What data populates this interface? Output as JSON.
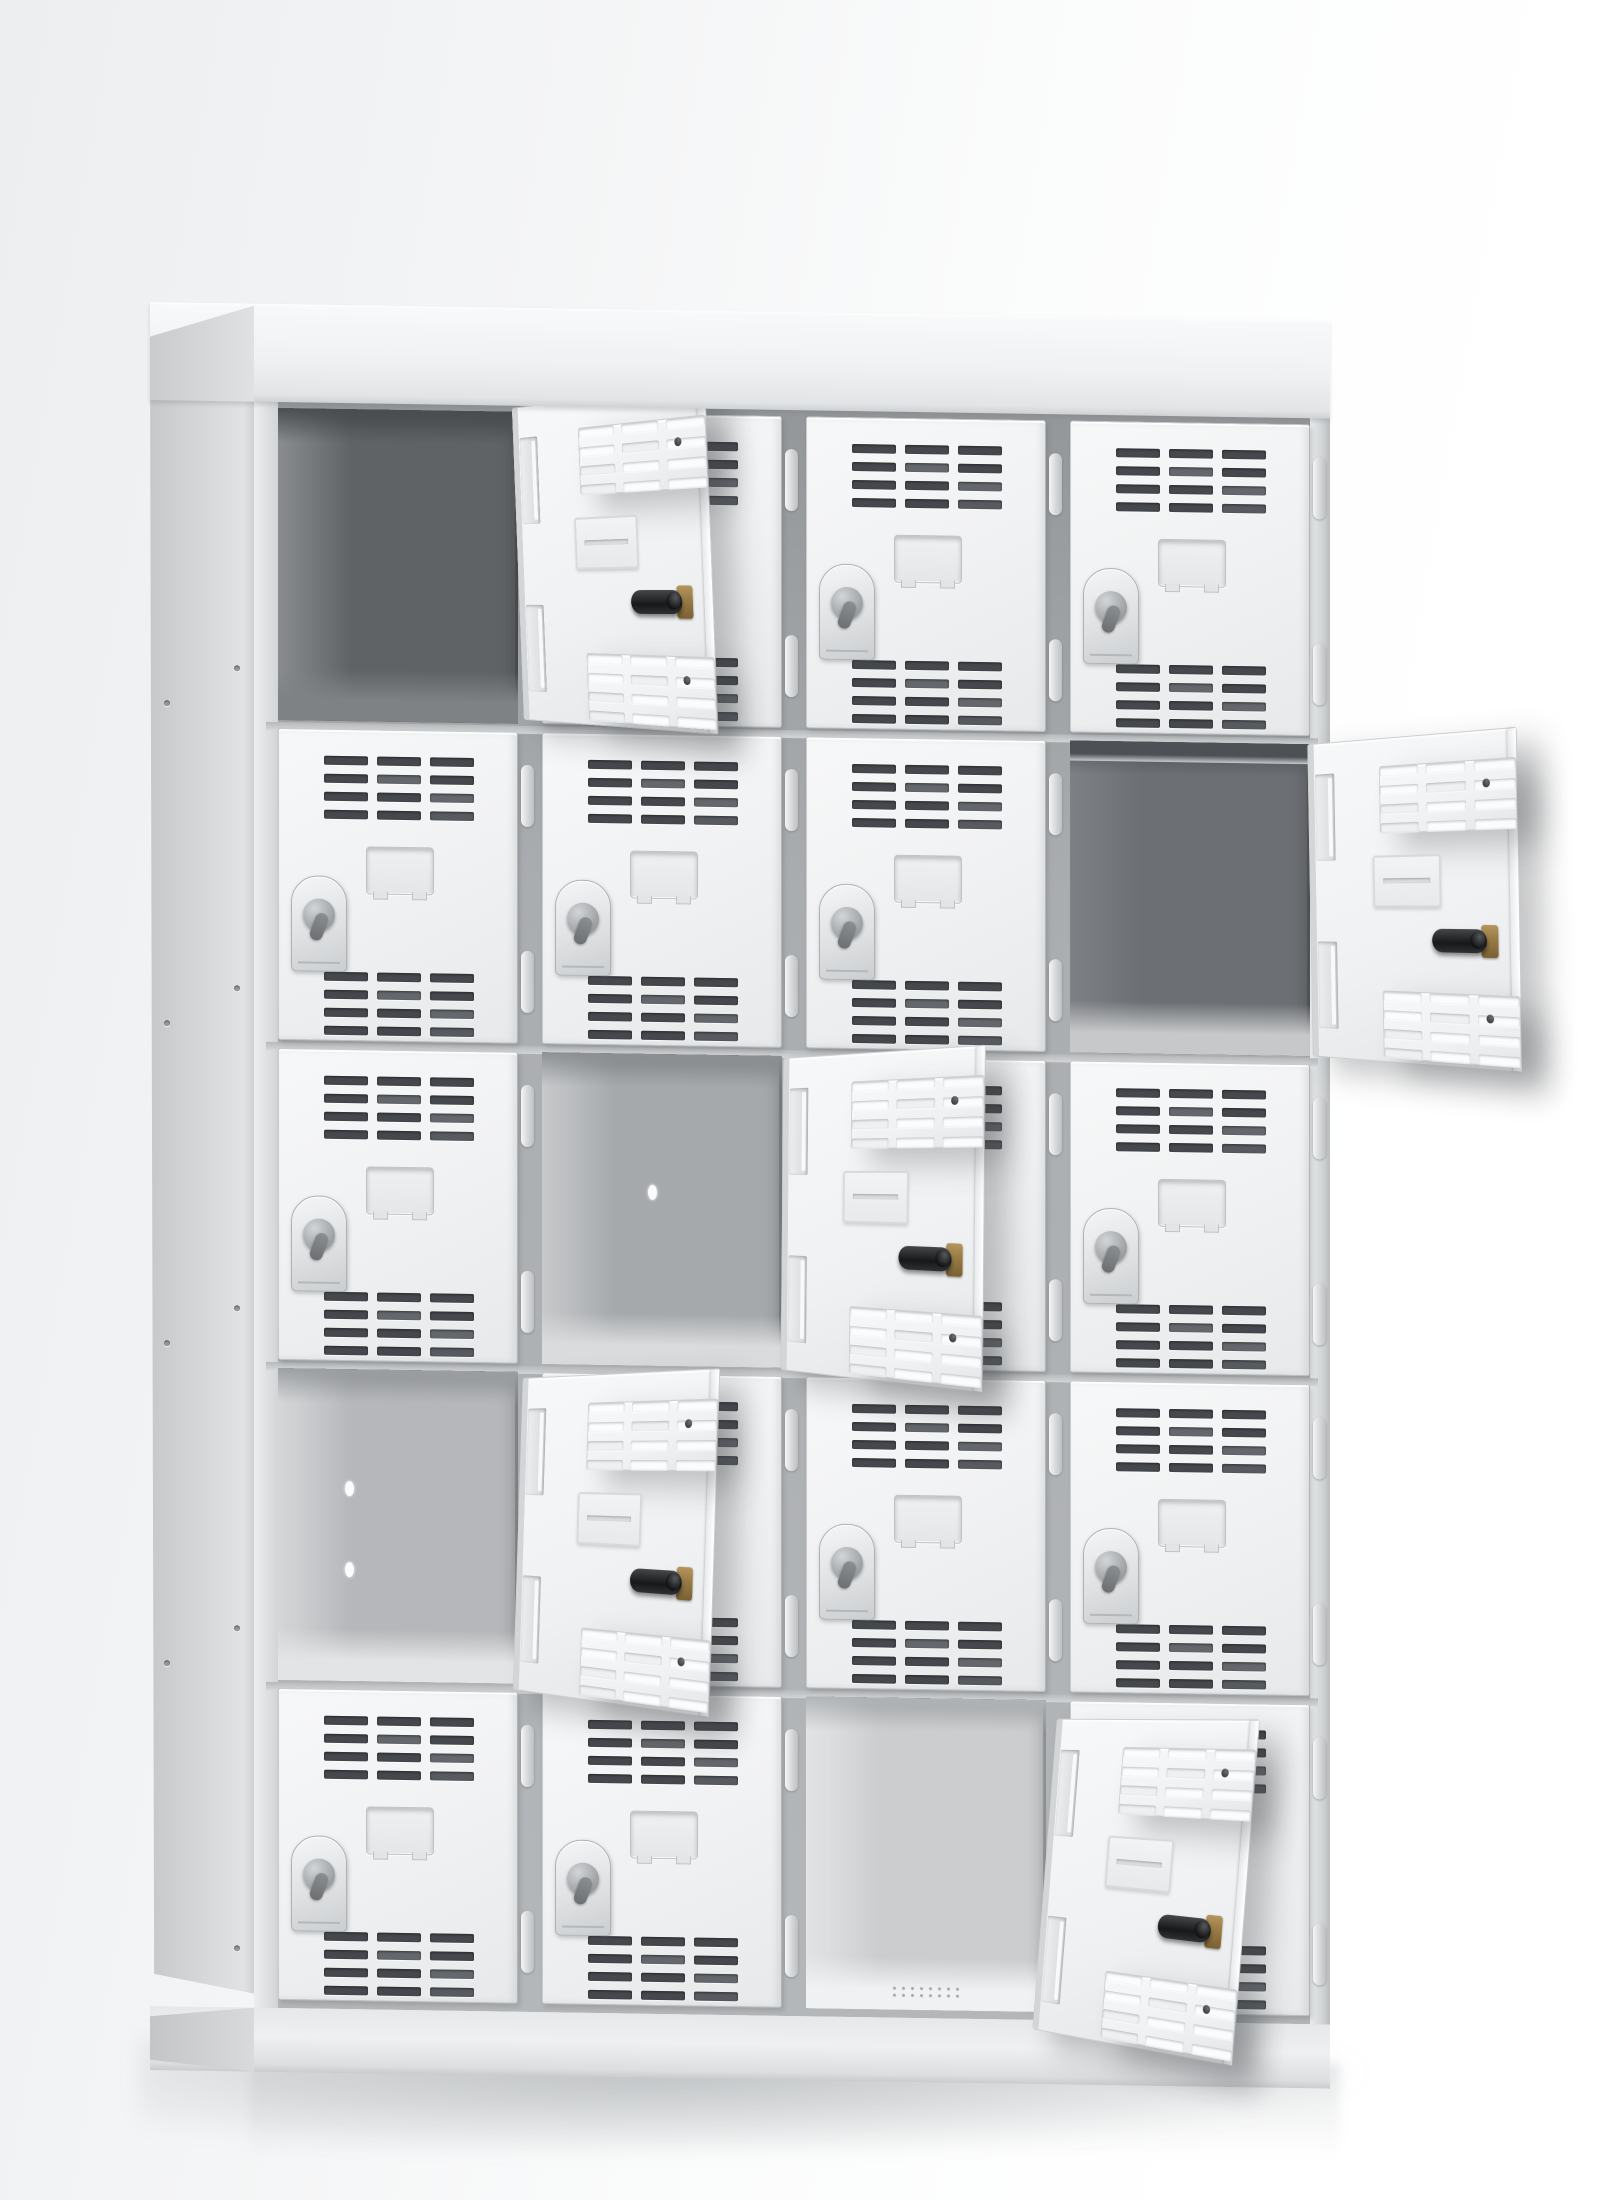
{
  "subject": "white steel multi-compartment locker cabinet, 4 columns by 5 rows, viewed from slightly left on a white studio background; five compartment doors are swung open",
  "palette": {
    "door_face": "#f1f2f3",
    "door_edge": "#c9ccce",
    "vent_slot": "#45484c",
    "frame": "#aaadb0",
    "side_panel": "#d5d7d9",
    "open_door_inner": "#f0f1f3",
    "lock_cylinder_black": "#17181a",
    "lock_cylinder_brass": "#9a7c46"
  },
  "locker": {
    "grid": {
      "rows": 5,
      "columns": 4,
      "compartments": 20
    },
    "counts": {
      "doors_closed": 15,
      "doors_open": 5,
      "vent_slots_per_door": 24,
      "vent_blocks_per_door": 2,
      "hinges_per_door": 2
    },
    "door_features": [
      "ventilation-slots-top",
      "ventilation-slots-bottom",
      "stamped-label-holder",
      "arch-cam-lock",
      "right-side-hinges"
    ],
    "cells": [
      [
        "open",
        "closed",
        "closed",
        "closed"
      ],
      [
        "closed",
        "closed",
        "closed",
        "open"
      ],
      [
        "closed",
        "open",
        "closed",
        "closed"
      ],
      [
        "open",
        "closed",
        "closed",
        "closed"
      ],
      [
        "closed",
        "closed",
        "open",
        "closed"
      ]
    ],
    "open_doors": [
      {
        "row": 1,
        "col": 1,
        "swing_deg": 136,
        "tilt_deg": -2.2,
        "drop_px": -4,
        "interior": {
          "tone": {
            "back": "#606366",
            "left": "#8a8d90",
            "floor": "#7f8285",
            "top": "#4b4e51"
          },
          "shelf": false,
          "holes": [],
          "floor_vents": false
        }
      },
      {
        "row": 2,
        "col": 4,
        "swing_deg": 142,
        "tilt_deg": -1.0,
        "drop_px": 0,
        "interior": {
          "tone": {
            "back": "#6c6f73",
            "left": "#7e8185",
            "floor": "#c6c8ca",
            "top": "#54575b"
          },
          "shelf": true,
          "holes": [],
          "floor_vents": false
        }
      },
      {
        "row": 3,
        "col": 2,
        "swing_deg": 139,
        "tilt_deg": 0.5,
        "drop_px": 2,
        "interior": {
          "tone": {
            "back": "#a6a9ac",
            "left": "#c8cacc",
            "floor": "#d9dbdc",
            "top": "#8e9194"
          },
          "shelf": false,
          "holes": [
            {
              "wall": "back",
              "x": 0.44,
              "y": 0.42
            }
          ],
          "floor_vents": false
        }
      },
      {
        "row": 4,
        "col": 1,
        "swing_deg": 137,
        "tilt_deg": 1.8,
        "drop_px": 6,
        "interior": {
          "tone": {
            "back": "#b5b7ba",
            "left": "#d6d8da",
            "floor": "#e2e4e5",
            "top": "#9da0a3"
          },
          "shelf": false,
          "holes": [
            {
              "wall": "left",
              "x": 0.28,
              "y": 0.36
            },
            {
              "wall": "left",
              "x": 0.28,
              "y": 0.62
            }
          ],
          "floor_vents": false
        }
      },
      {
        "row": 5,
        "col": 3,
        "swing_deg": 139,
        "tilt_deg": 4.5,
        "drop_px": 18,
        "interior": {
          "tone": {
            "back": "#cbcdcf",
            "left": "#e3e5e6",
            "floor": "#f0f1f2",
            "top": "#b2b5b7"
          },
          "shelf": false,
          "holes": [],
          "floor_vents": true
        }
      }
    ],
    "side_hole_rows": [
      362,
      682,
      1002,
      1322,
      1642
    ]
  }
}
